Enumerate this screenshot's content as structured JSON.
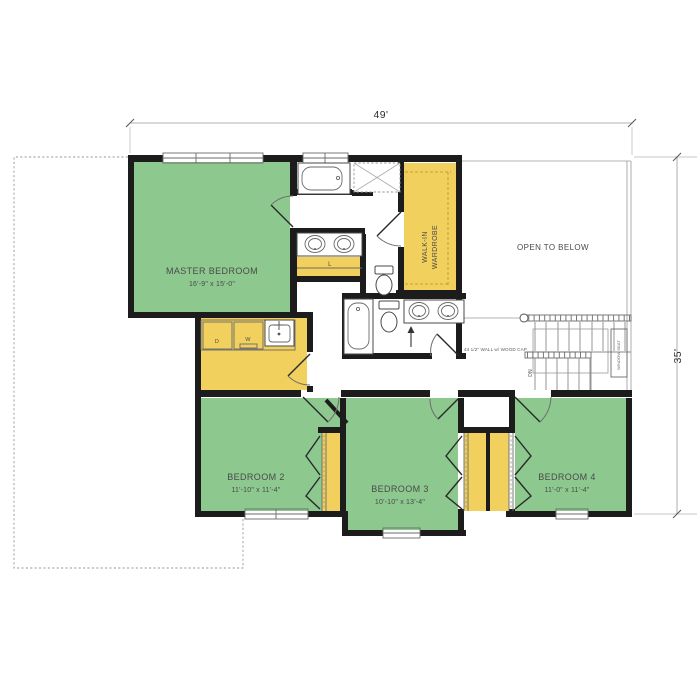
{
  "plan": {
    "dimensions": {
      "overall_width": "49'",
      "overall_height": "35'"
    },
    "rooms": {
      "master_bedroom": {
        "name": "MASTER BEDROOM",
        "size": "16'-9\" x 15'-0\""
      },
      "bedroom2": {
        "name": "BEDROOM 2",
        "size": "11'-10\" x 11'-4\""
      },
      "bedroom3": {
        "name": "BEDROOM 3",
        "size": "10'-10\" x 13'-4\""
      },
      "bedroom4": {
        "name": "BEDROOM 4",
        "size": "11'-0\" x 11'-4\""
      },
      "walk_in_wardrobe": {
        "line1": "WALK-IN",
        "line2": "WARDROBE"
      },
      "open_to_below": {
        "name": "OPEN TO BELOW"
      }
    },
    "annotations": {
      "half_wall": "44 1/2\" WALL w/ WOOD CAP",
      "window_seat": "WINDOW SEAT",
      "stairs_down": "DN",
      "linen_closet": "L",
      "dryer": "D",
      "washer": "W"
    },
    "colors": {
      "room_green": "#8dc88e",
      "closet_yellow": "#f2d05e",
      "wall_black": "#1c1c1c",
      "line_gray": "#9a9a9a",
      "text_gray": "#4a4a4a"
    }
  }
}
